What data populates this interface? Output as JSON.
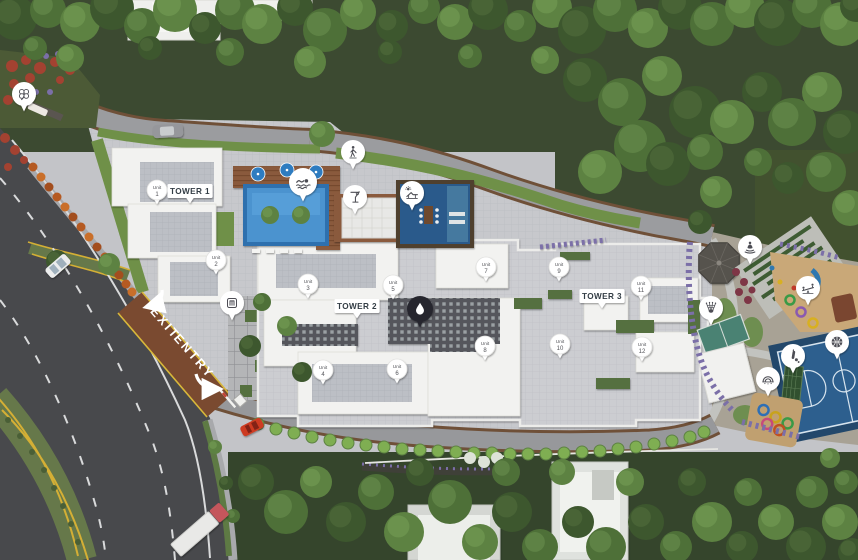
{
  "canvas": {
    "width": 858,
    "height": 560
  },
  "colors": {
    "marker_bg": "#ffffff",
    "marker_dark_bg": "#26262e",
    "marker_text": "#54555a",
    "tower_text": "#333c44",
    "gate_text": "#ffffff",
    "pool_blue": "#3f85c4",
    "court_blue": "#2d5f8e",
    "road_yellow": "#d4af35"
  },
  "towers": [
    {
      "id": "tower-1",
      "label": "TOWER 1",
      "x": 190,
      "y": 191
    },
    {
      "id": "tower-2",
      "label": "TOWER 2",
      "x": 357,
      "y": 306
    },
    {
      "id": "tower-3",
      "label": "TOWER 3",
      "x": 602,
      "y": 296
    }
  ],
  "unit_label": "Unit",
  "units": [
    {
      "number": "1",
      "x": 157,
      "y": 190
    },
    {
      "number": "2",
      "x": 216,
      "y": 260
    },
    {
      "number": "3",
      "x": 308,
      "y": 284
    },
    {
      "number": "4",
      "x": 323,
      "y": 370
    },
    {
      "number": "5",
      "x": 393,
      "y": 285
    },
    {
      "number": "6",
      "x": 397,
      "y": 369
    },
    {
      "number": "7",
      "x": 486,
      "y": 267
    },
    {
      "number": "8",
      "x": 485,
      "y": 346
    },
    {
      "number": "9",
      "x": 559,
      "y": 267
    },
    {
      "number": "10",
      "x": 560,
      "y": 344
    },
    {
      "number": "11",
      "x": 641,
      "y": 286
    },
    {
      "number": "12",
      "x": 642,
      "y": 347
    }
  ],
  "amenity_icons": [
    {
      "name": "clover",
      "x": 24,
      "y": 94
    },
    {
      "name": "walking-person",
      "x": 353,
      "y": 152
    },
    {
      "name": "swimmer",
      "x": 303,
      "y": 182,
      "r": 14
    },
    {
      "name": "martini",
      "x": 355,
      "y": 197
    },
    {
      "name": "sun-lounger",
      "x": 412,
      "y": 193
    },
    {
      "name": "pergola",
      "x": 232,
      "y": 303
    },
    {
      "name": "water-drop",
      "x": 420,
      "y": 309,
      "style": "dark"
    },
    {
      "name": "meditation",
      "x": 750,
      "y": 247
    },
    {
      "name": "seesaw",
      "x": 808,
      "y": 288
    },
    {
      "name": "shuttlecock",
      "x": 711,
      "y": 308
    },
    {
      "name": "cricket",
      "x": 793,
      "y": 356
    },
    {
      "name": "basketball",
      "x": 837,
      "y": 342
    },
    {
      "name": "rainbow",
      "x": 768,
      "y": 379
    }
  ],
  "gate_labels": [
    {
      "text": "EXIT",
      "x": 162,
      "y": 326
    },
    {
      "text": "ENTRY",
      "x": 191,
      "y": 359
    }
  ]
}
